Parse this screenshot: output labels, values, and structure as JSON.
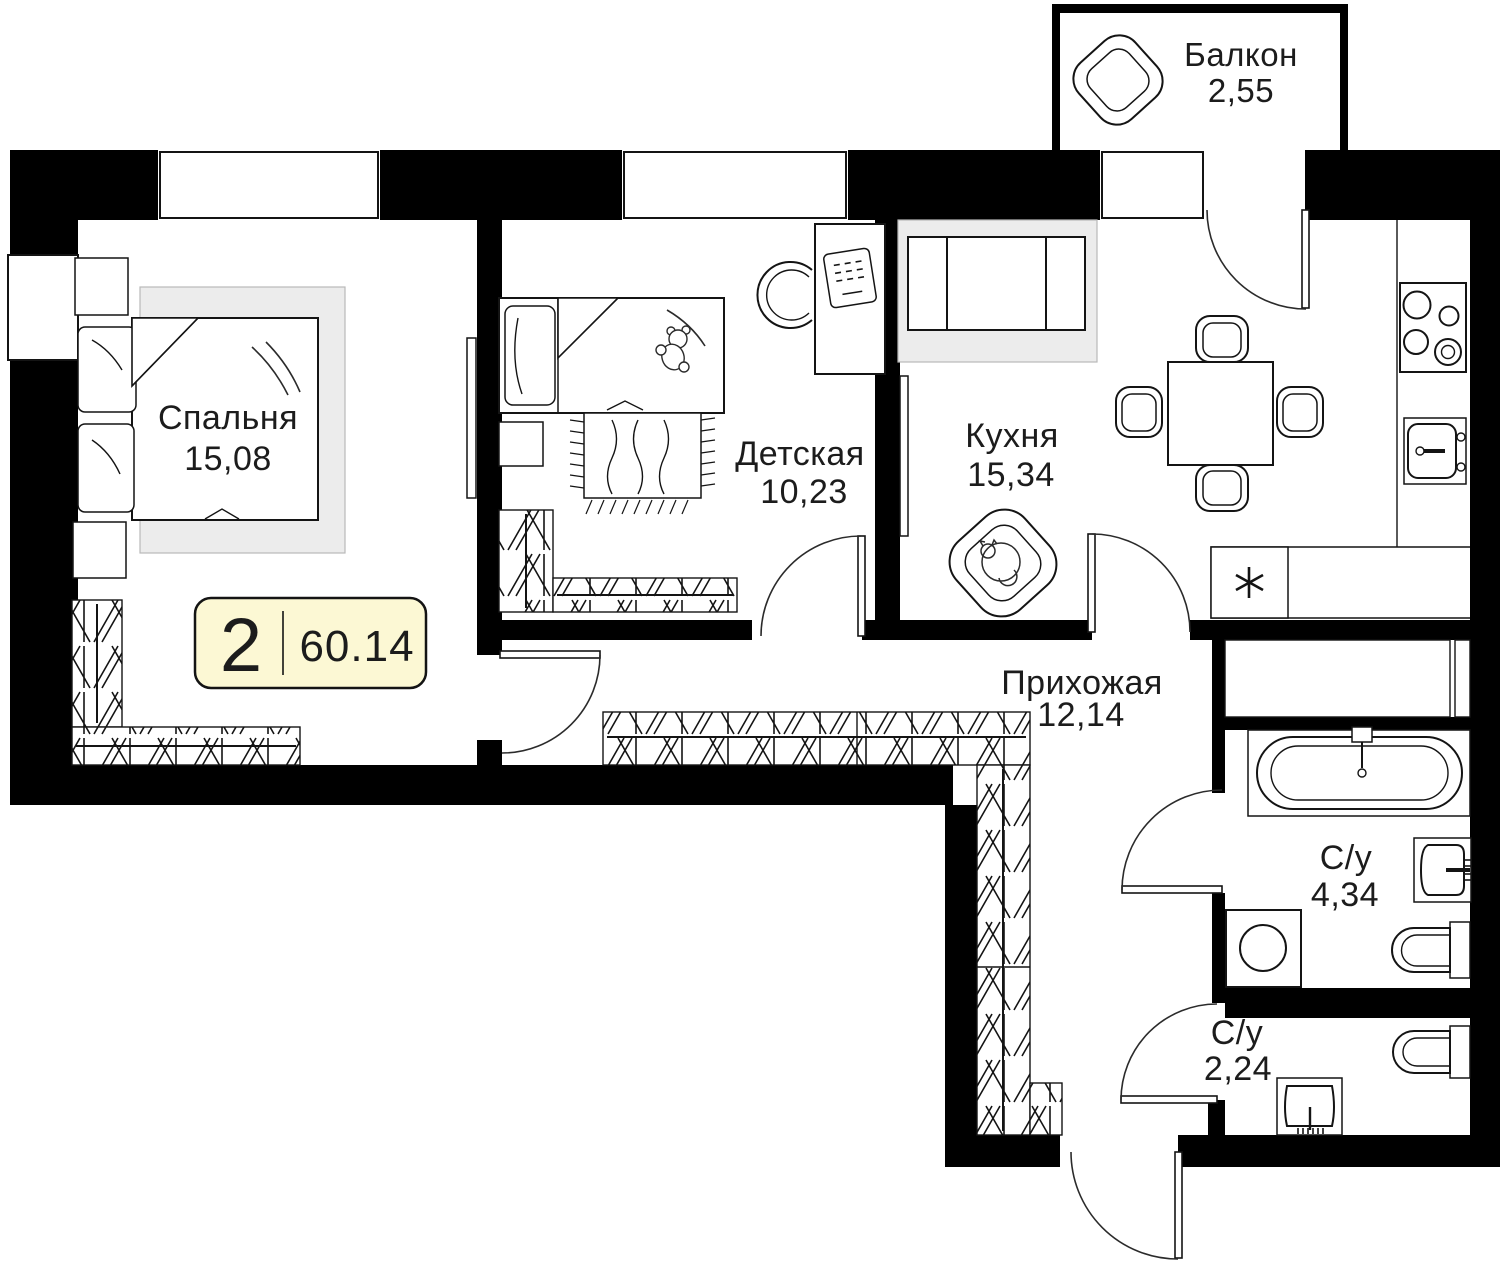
{
  "plan": {
    "badge": {
      "rooms_count": "2",
      "total_area": "60.14"
    },
    "rooms": [
      {
        "name": "Балкон",
        "area": "2,55"
      },
      {
        "name": "Спальня",
        "area": "15,08"
      },
      {
        "name": "Детская",
        "area": "10,23"
      },
      {
        "name": "Кухня",
        "area": "15,34"
      },
      {
        "name": "Прихожая",
        "area": "12,14"
      },
      {
        "name": "С/у",
        "area": "4,34"
      },
      {
        "name": "С/у",
        "area": "2,24"
      }
    ],
    "colors": {
      "walls": "#000000",
      "lines": "#141414",
      "badge_fill": "#fcf8d4",
      "rug_fill": "#ececec",
      "background": "#ffffff"
    }
  }
}
